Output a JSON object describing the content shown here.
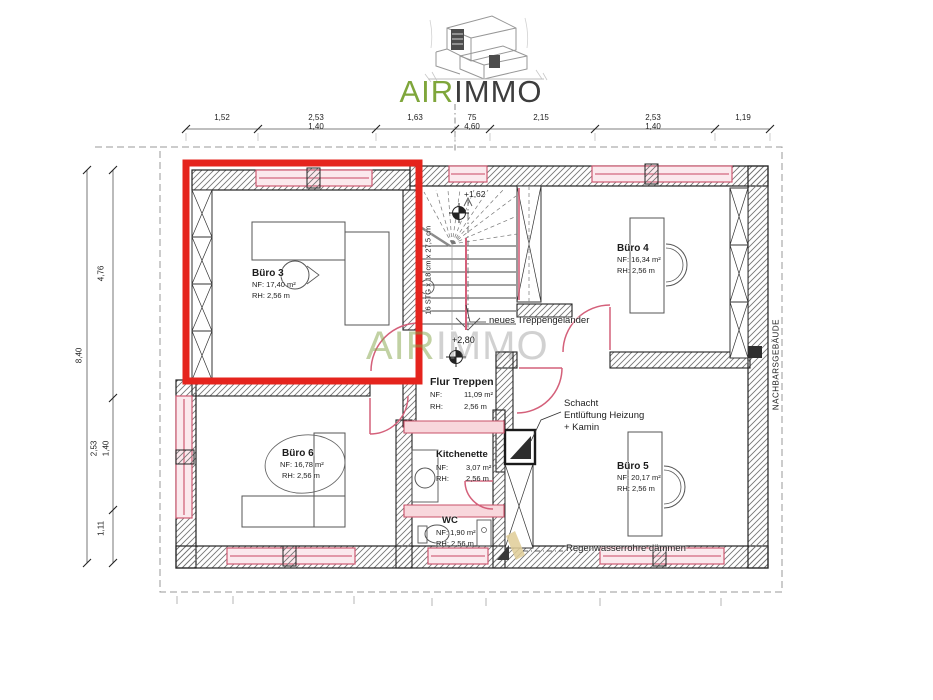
{
  "logo": {
    "air": "AIR",
    "immo": "IMMO"
  },
  "watermark": {
    "air": "AIR",
    "immo": "IMMO"
  },
  "dims_top": [
    {
      "main": "1,52",
      "sub": ""
    },
    {
      "main": "2,53",
      "sub": "1,40"
    },
    {
      "main": "1,63",
      "sub": ""
    },
    {
      "main": "75",
      "sub": "4,60"
    },
    {
      "main": "2,15",
      "sub": ""
    },
    {
      "main": "2,53",
      "sub": "1,40"
    },
    {
      "main": "1,19",
      "sub": ""
    }
  ],
  "dims_left": {
    "total": "8,40",
    "seg1": "4,76",
    "seg2_main": "2,53",
    "seg2_sub": "1,40",
    "seg3": "1,11"
  },
  "rooms": {
    "buro3": {
      "name": "Büro 3",
      "nf": "NF: 17,40 m²",
      "rh": "RH: 2,56 m"
    },
    "buro4": {
      "name": "Büro 4",
      "nf": "NF: 16,34 m²",
      "rh": "RH: 2,56 m"
    },
    "buro5": {
      "name": "Büro 5",
      "nf": "NF: 20,17 m²",
      "rh": "RH: 2,56 m"
    },
    "buro6": {
      "name": "Büro 6",
      "nf": "NF: 16,78 m²",
      "rh": "RH: 2,56 m"
    },
    "flur": {
      "name": "Flur Treppen",
      "nf_label": "NF:",
      "nf_value": "11,09 m²",
      "rh_label": "RH:",
      "rh_value": "2,56 m"
    },
    "kitchenette": {
      "name": "Kitchenette",
      "nf_label": "NF:",
      "nf_value": "3,07 m²",
      "rh_label": "RH:",
      "rh_value": "2,56 m"
    },
    "wc": {
      "name": "WC",
      "nf": "NF: 1,90 m²",
      "rh": "RH: 2,56 m"
    }
  },
  "annotations": {
    "stair_note": "16 STG x 18 cm x 27,5 cm",
    "level_upper": "+1,62",
    "level_lower": "+2,80",
    "railing": "neues Treppengeländer",
    "shaft_line1": "Schacht",
    "shaft_line2": "Entlüftung Heizung",
    "shaft_line3": "+ Kamin",
    "rain": "Regenwasserrohre dämmen",
    "neighbor": "NACHBARSGEBÄUDE"
  },
  "colors": {
    "highlight_red": "#e5241d",
    "window_pink": "#cf5a72",
    "logo_green": "#7fa63b",
    "logo_dark": "#3d3d3d"
  }
}
